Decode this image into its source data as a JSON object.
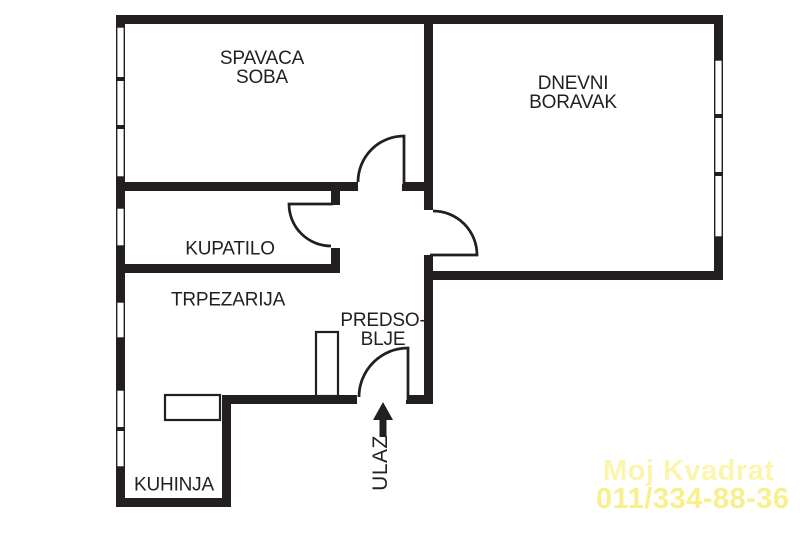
{
  "title": "Apartment floor plan",
  "colors": {
    "wall": "#231f20",
    "background": "#ffffff",
    "watermark_line1": "#fbf5b0",
    "watermark_line2": "#f8f08c"
  },
  "rooms": [
    {
      "id": "spavaca-soba",
      "label": "SPAVACA\nSOBA"
    },
    {
      "id": "dnevni-boravak",
      "label": "DNEVNI\nBORAVAK"
    },
    {
      "id": "kupatilo",
      "label": "KUPATILO"
    },
    {
      "id": "trpezarija",
      "label": "TRPEZARIJA"
    },
    {
      "id": "predsoblje",
      "label": "PREDSO-\nBLJE"
    },
    {
      "id": "kuhinja",
      "label": "KUHINJA"
    }
  ],
  "entrance": {
    "label": "ULAZ"
  },
  "icons": {
    "entrance_arrow": "up-arrow"
  },
  "watermark": {
    "line1": "Moj Kvadrat",
    "line2": "011/334-88-36"
  }
}
